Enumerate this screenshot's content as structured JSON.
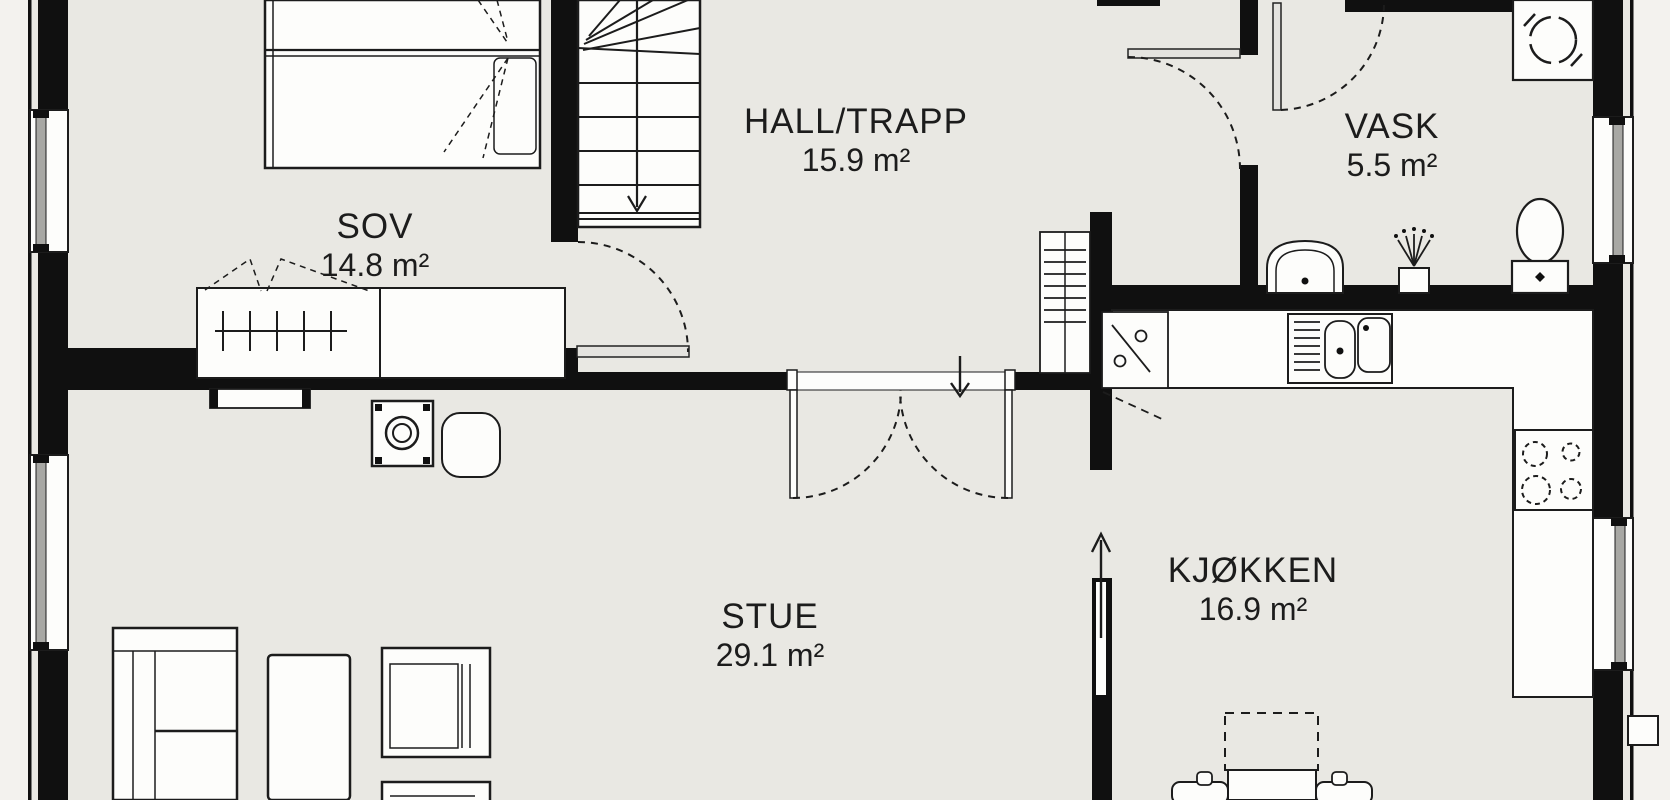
{
  "plan": {
    "rooms": [
      {
        "id": "sov",
        "name": "SOV",
        "area": "14.8 m²"
      },
      {
        "id": "hall",
        "name": "HALL/TRAPP",
        "area": "15.9 m²"
      },
      {
        "id": "vask",
        "name": "VASK",
        "area": "5.5 m²"
      },
      {
        "id": "stue",
        "name": "STUE",
        "area": "29.1 m²"
      },
      {
        "id": "kjokken",
        "name": "KJØKKEN",
        "area": "16.9 m²"
      }
    ],
    "colors": {
      "floor": "#e9e8e3",
      "outside": "#f3f2ee",
      "wall": "#101010",
      "line": "#1c1c1c",
      "fixture": "#fdfdfb",
      "sash": "#a8a8a4"
    },
    "fixtures": [
      "staircase",
      "stair-down-arrow",
      "double-bed",
      "wardrobe",
      "wardrobe-doors",
      "interior-door",
      "double-door",
      "entry-arrow",
      "radiator",
      "wood-stove",
      "sideboard",
      "side-table",
      "sofa",
      "coffee-table",
      "armchair",
      "washing-machine",
      "bathroom-sink",
      "floor-drain",
      "toilet",
      "kitchen-counter",
      "dishwasher",
      "kitchen-sink",
      "cooktop",
      "dining-table",
      "dining-chair",
      "window",
      "kitchen-arrow"
    ]
  }
}
